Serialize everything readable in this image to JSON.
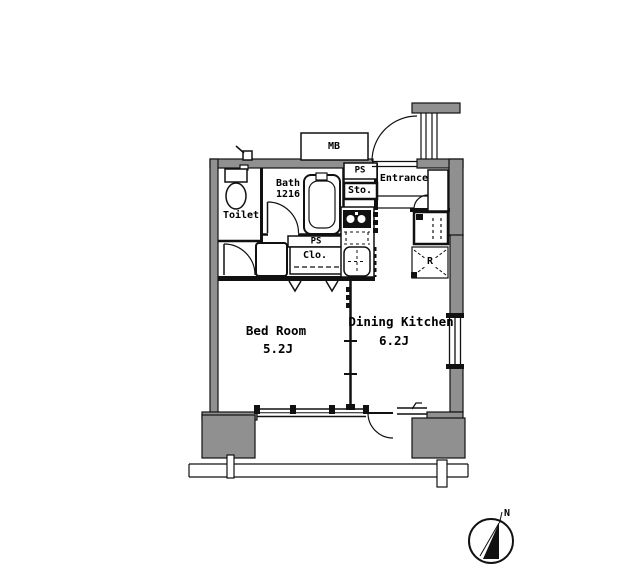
{
  "floor_plan": {
    "rooms": {
      "bedroom": {
        "name": "Bed Room",
        "size": "5.2J"
      },
      "dining_kitchen": {
        "name": "Dining Kitchen",
        "size": "6.2J"
      },
      "toilet": {
        "name": "Toilet"
      },
      "bath": {
        "name": "Bath",
        "size": "1216"
      },
      "entrance": {
        "name": "Entrance"
      }
    },
    "features": {
      "meter_box": "MB",
      "pipe_space_entrance": "PS",
      "pipe_space_closet": "PS",
      "storage": "Sto.",
      "closet": "Clo.",
      "refrigerator_space": "R"
    },
    "compass": {
      "north_label": "N"
    },
    "colors": {
      "wall_fill": "#909090",
      "line": "#111111",
      "background": "#ffffff"
    }
  }
}
